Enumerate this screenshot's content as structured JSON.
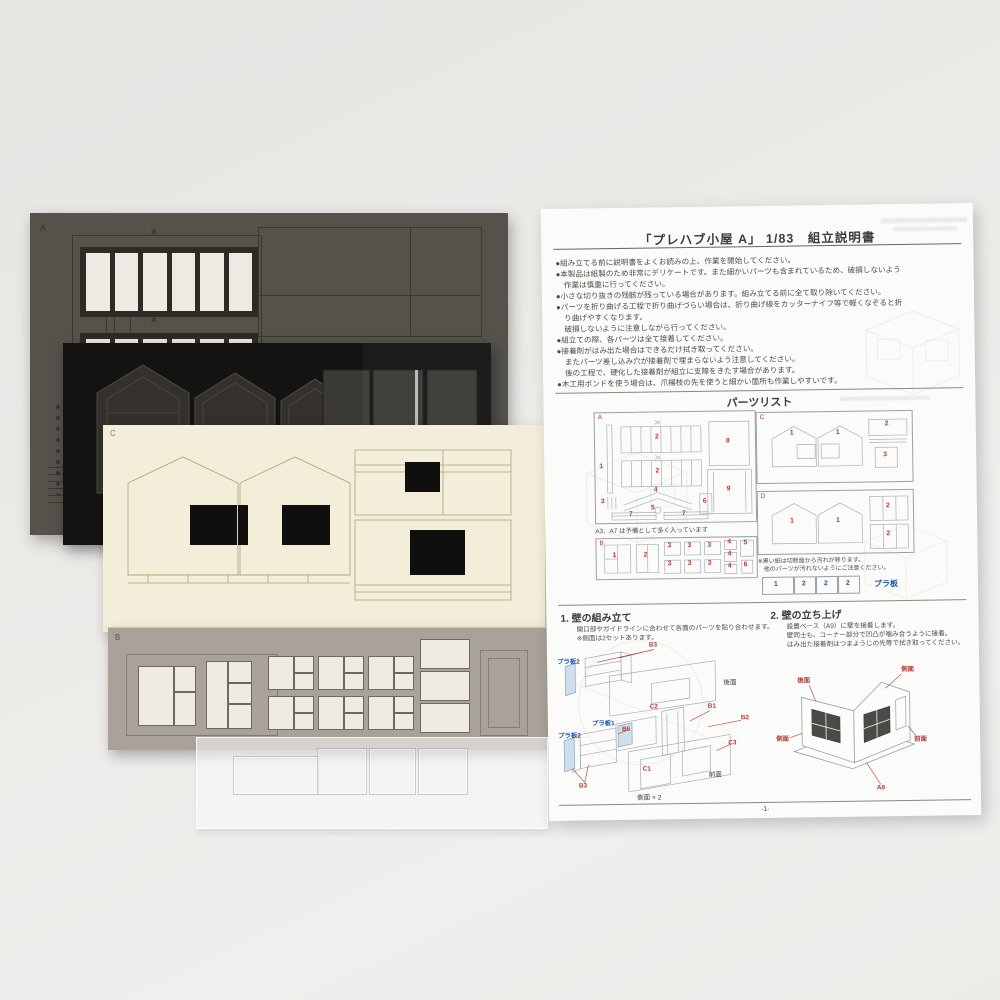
{
  "photo": {
    "background": "#eceae7"
  },
  "colors": {
    "red_label": "#b23a36",
    "blue_label": "#1d56a5",
    "sheet_a": "#55524c",
    "sheet_black": "#141311",
    "sheet_c": "#f2eed9",
    "sheet_b": "#a8a298"
  },
  "sheets": {
    "a": {
      "letter": "A",
      "x_mark": "✕"
    },
    "c": {
      "letter": "C"
    },
    "b": {
      "letter": "B"
    }
  },
  "paper": {
    "title": "「プレハブ小屋 A」 1/83　組立説明書",
    "intro_lines": [
      {
        "t": "●組み立てる前に説明書をよくお読みの上、作業を開始してください。"
      },
      {
        "t": "●本製品は紙製のため非常にデリケートです。また細かいパーツも含まれているため、破損しないよう"
      },
      {
        "t": "作業は慎重に行ってください。"
      },
      {
        "t": "●小さな切り抜きの残骸が残っている場合があります。組み立てる前に全て取り除いてください。"
      },
      {
        "t": "●パーツを折り曲げる工程で折り曲げづらい場合は、折り曲げ線をカッターナイフ等で軽くなぞると折"
      },
      {
        "t": "り曲げやすくなります。"
      },
      {
        "t": "破損しないように注意しながら行ってください。"
      },
      {
        "t": "●組立ての際、各パーツは全て接着してください。"
      },
      {
        "t": "●接着剤がはみ出た場合はできるだけ拭き取ってください。"
      },
      {
        "t": "またパーツ差し込み穴が接着剤で埋まらないよう注意してください。"
      },
      {
        "t": "後の工程で、硬化した接着剤が組立に支障をきたす場合があります。"
      },
      {
        "t": "●木工用ボンドを使う場合は、爪楊枝の先を使うと細かい箇所も作業しやすいです。"
      }
    ],
    "parts_list": {
      "heading": "パーツリスト",
      "a": {
        "label": "A",
        "numbers": [
          "1",
          "2",
          "2",
          "3",
          "4",
          "5",
          "6",
          "7",
          "7",
          "8",
          "9"
        ],
        "note": "A3、A7 は予備として多く入っています"
      },
      "b": {
        "label": "B",
        "numbers": [
          "1",
          "2",
          "3",
          "3",
          "3",
          "3",
          "3",
          "3",
          "4",
          "4",
          "4",
          "5",
          "6"
        ]
      },
      "c": {
        "label": "C",
        "numbers": [
          "1",
          "1",
          "2",
          "3"
        ]
      },
      "d": {
        "label": "D",
        "numbers": [
          "1",
          "1",
          "2",
          "2"
        ]
      },
      "black_note_1": "※黒い紙は切断面から汚れが移ります。",
      "black_note_2": "他のパーツが汚れないようにご注意ください。",
      "pla": {
        "cells": [
          "1",
          "2",
          "2",
          "2"
        ],
        "label": "プラ板"
      }
    },
    "step1": {
      "heading": "1. 壁の組み立て",
      "line1": "開口部やガイドラインに合わせて各面のパーツを貼り合わせます。",
      "line2": "※側面は2セットあります。",
      "labels": {
        "b3_top": "B3",
        "pla2_top": "プラ板2",
        "rear": "後面",
        "c2": "C2",
        "b1": "B1",
        "b2": "B2",
        "pla1": "プラ板1",
        "b6": "B6",
        "pla2_bottom": "プラ板2",
        "b3_bottom": "B3",
        "c3": "C3",
        "c1": "C1",
        "front": "前面",
        "caption": "側面 × 2"
      }
    },
    "step2": {
      "heading": "2. 壁の立ち上げ",
      "line1": "設置ベース（A9）に壁を接着します。",
      "line2": "壁同士も、コーナー部分で凹凸が噛み合うように接着。",
      "line3": "はみ出た接着剤はつまようじの先等で拭き取ってください。",
      "labels": {
        "rear": "後面",
        "side_r": "側面",
        "front": "前面",
        "side_l": "側面",
        "a9": "A9"
      }
    },
    "page_number": "-1-"
  }
}
